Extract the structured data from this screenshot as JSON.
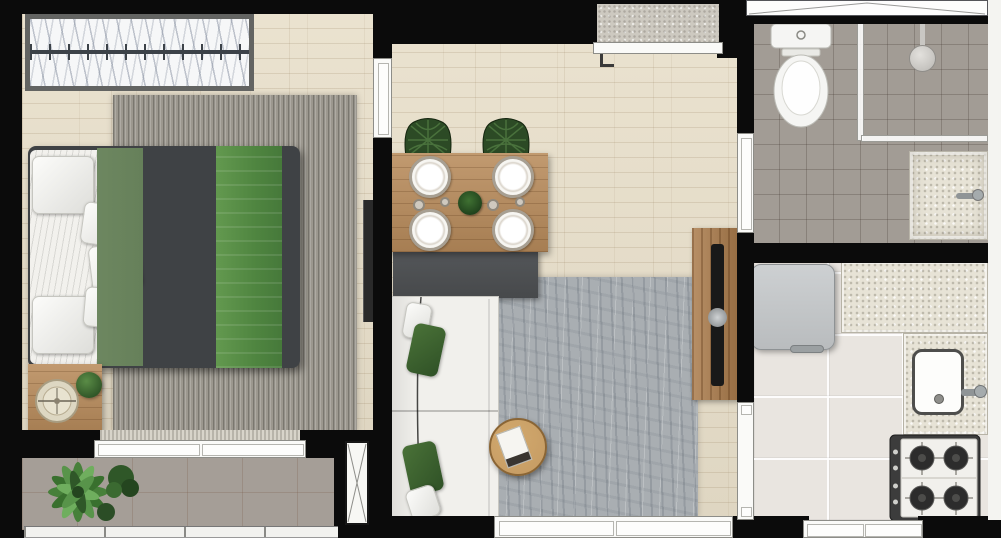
{
  "meta": {
    "kind": "apartment-floor-plan-render",
    "canvas": {
      "width": 1001,
      "height": 538
    }
  },
  "palette": {
    "wall": "#0b0b0b",
    "wood": "#e8dfca",
    "rug-bedroom": "#9c988f",
    "rug-living": "#a9aeb2",
    "tile-bath": "#a29c95",
    "tile-balcony": "#a59e97",
    "tile-kitchen": "#e9e5e0",
    "counter": "#e7e3d6",
    "concrete": "#cdc9c0",
    "table-wood": "#b98c5c",
    "console-wood": "#ab7c4c",
    "coffee-wood": "#c49a62",
    "bed-dark": "#3f4245",
    "bed-olive": "#66805a",
    "bed-green": "#579048",
    "chair-green": "#2c4a25",
    "pillow-green": "#2f5126",
    "sofa-white": "#f1f0ec",
    "sideboard": "#47494b",
    "fixture-white": "#f5f5f3",
    "fridge-gray": "#b9bcbe",
    "tv-black": "#191919",
    "plant-green": "#47803a"
  },
  "rooms": [
    {
      "id": "bedroom",
      "contents": [
        "wardrobe-with-hangers",
        "double-bed",
        "striped-rug",
        "nightstand",
        "round-tray",
        "small-plant",
        "sliding-door"
      ]
    },
    {
      "id": "living-dining",
      "contents": [
        "dining-table",
        "four-plates",
        "centerpiece-plant",
        "two-green-chairs",
        "sideboard",
        "white-sofa",
        "green-cushions",
        "area-rug",
        "round-coffee-table",
        "book",
        "tv-console",
        "tv"
      ]
    },
    {
      "id": "bathroom",
      "contents": [
        "toilet",
        "shower-area",
        "shower-head",
        "glass-partition",
        "vanity-sink",
        "window"
      ]
    },
    {
      "id": "kitchen",
      "contents": [
        "refrigerator",
        "l-shaped-counter",
        "sink-with-faucet",
        "four-burner-stove",
        "window"
      ]
    },
    {
      "id": "balcony",
      "contents": [
        "plants",
        "glass-railing",
        "tiled-floor"
      ]
    },
    {
      "id": "entry",
      "contents": [
        "entry-door-threshold"
      ]
    }
  ]
}
